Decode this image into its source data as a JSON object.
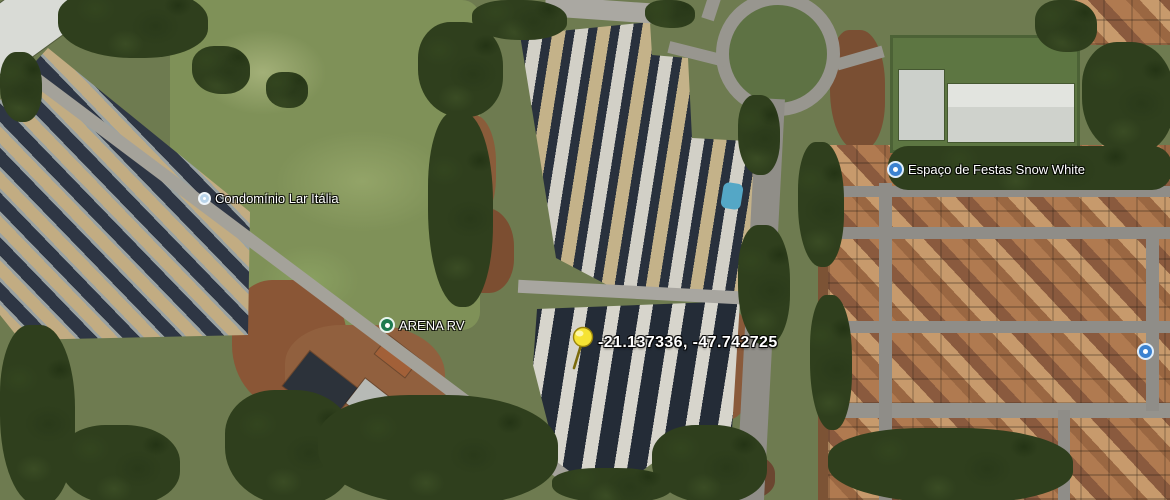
{
  "view": {
    "kind": "satellite-imagery",
    "width_px": 1170,
    "height_px": 500
  },
  "pois": [
    {
      "id": "condominio-lar-italia",
      "label": "Condomínio Lar Itália",
      "icon": "pale-poi-dot-icon",
      "color": "#b9d4ea"
    },
    {
      "id": "arena-rv",
      "label": "ARENA RV",
      "icon": "green-poi-dot-icon",
      "color": "#1d7a4f"
    },
    {
      "id": "espaco-de-festas-snow-white",
      "label": "Espaço de Festas Snow White",
      "icon": "blue-poi-dot-icon",
      "color": "#3b82d0"
    },
    {
      "id": "unlabeled-right-edge-poi",
      "label": "",
      "icon": "blue-poi-dot-icon",
      "color": "#3b82d0"
    }
  ],
  "placemark": {
    "coordinates_label": "-21.137336, -47.742725",
    "pin_color": "#f5e334"
  },
  "palette": {
    "label_text": "#ffffff",
    "trees_dark_green": "#2f3f1d",
    "field_green": "#7f9158",
    "road_gray": "#a4a29a",
    "roof_orange": "#b07a50",
    "housing_row_tan": "#c2ac82",
    "housing_row_white": "#d7d5cc",
    "large_building_white": "#d7d9d4",
    "pool_blue": "#54a7c6"
  }
}
